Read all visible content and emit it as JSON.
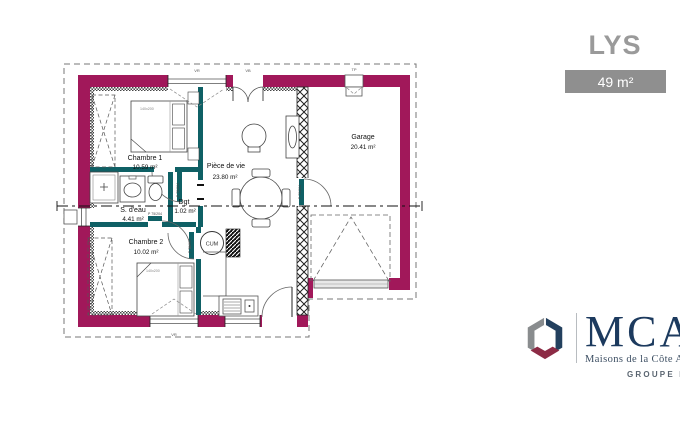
{
  "header": {
    "title": "LYS",
    "area_badge": "49 m²"
  },
  "plan": {
    "rooms": [
      {
        "name": "Chambre 1",
        "area": "10.59 m²"
      },
      {
        "name": "S. d'eau",
        "area": "4.41 m²"
      },
      {
        "name": "Dgt",
        "area": "1.02 m²"
      },
      {
        "name": "Chambre 2",
        "area": "10.02 m²"
      },
      {
        "name": "Pièce de vie",
        "area": "23.80 m²"
      },
      {
        "name": "Garage",
        "area": "20.41 m²"
      }
    ],
    "labels": {
      "water_heater": "CUM",
      "bed_size": "140x200",
      "door_size": "P 75/204",
      "window_vr": "VR",
      "window_entry": "VB",
      "window_garage": "TP"
    },
    "colors": {
      "exterior_wall": "#A1185A",
      "interior_wall": "#0F6065"
    }
  },
  "branding": {
    "name": "MCA",
    "subtitle": "Maisons de la Côte Atlantique",
    "group": "GROUPE HEXAOM"
  }
}
